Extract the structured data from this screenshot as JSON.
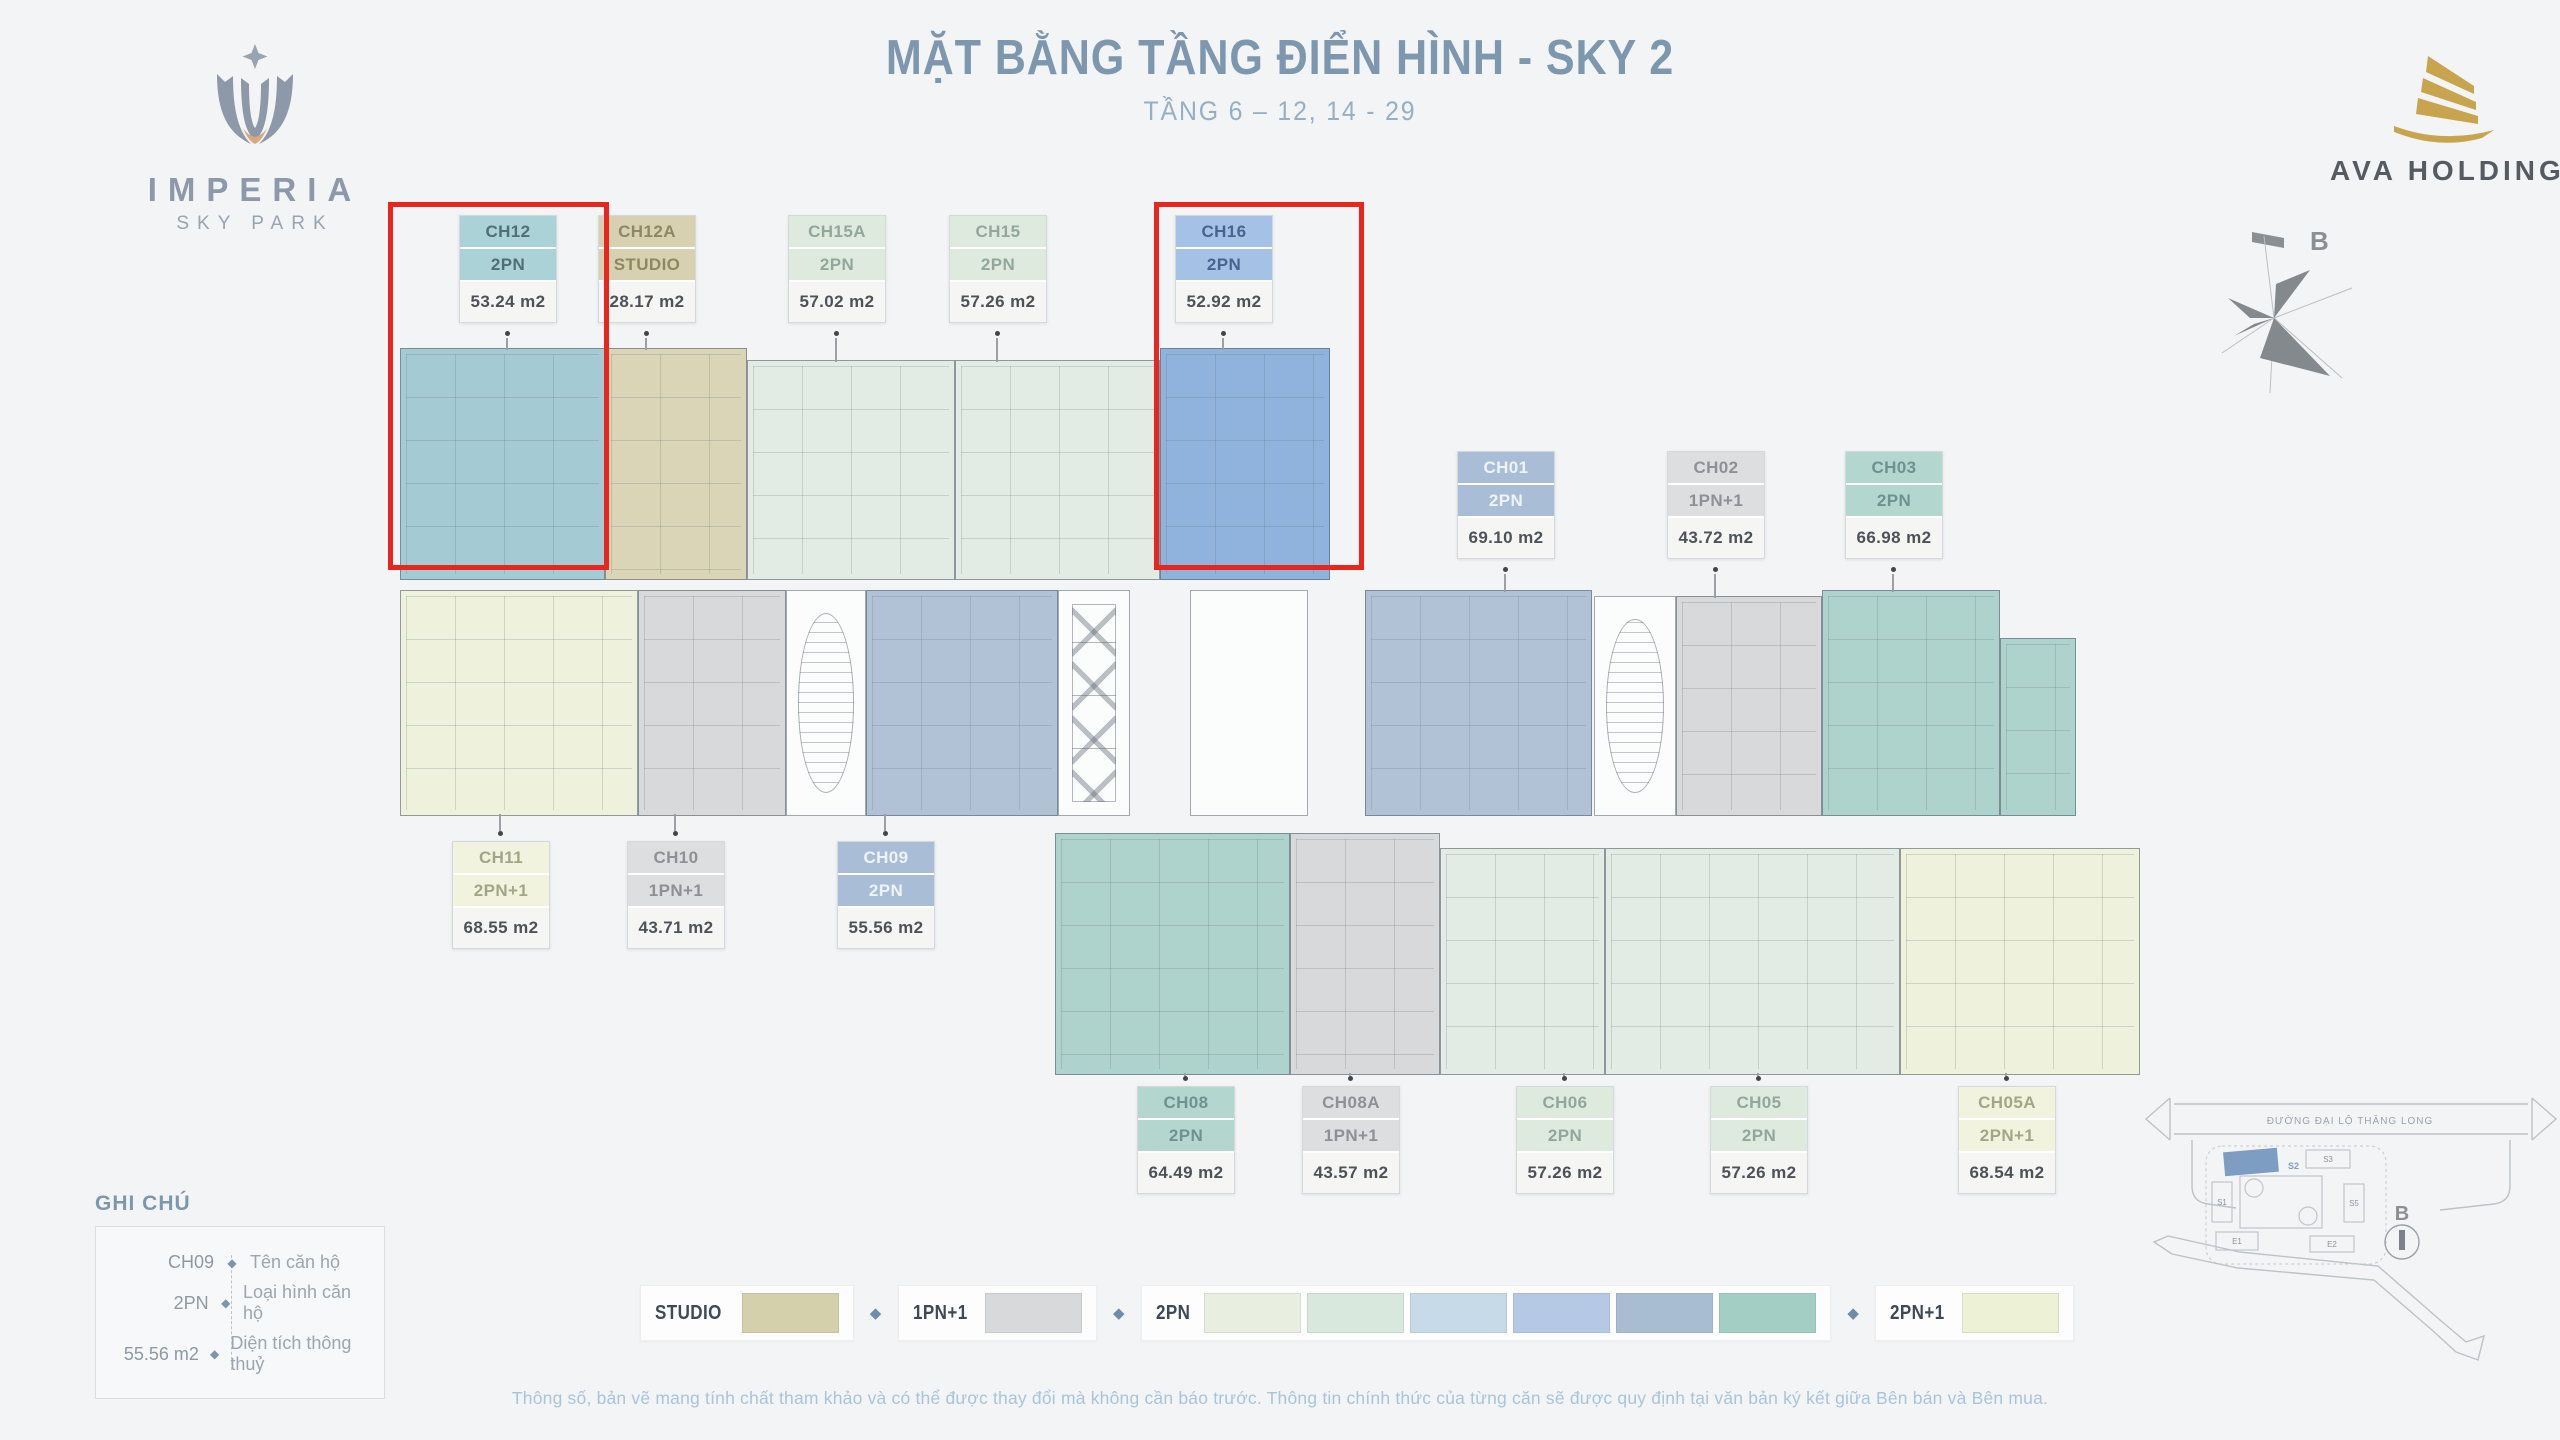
{
  "header": {
    "title": "MẶT BẰNG TẦNG ĐIỂN HÌNH - SKY 2",
    "subtitle": "TẦNG 6 – 12, 14 - 29",
    "imperia_logo": {
      "line1": "IMPERIA",
      "line2": "SKY PARK"
    },
    "ava_logo": "AVA HOLDINGS",
    "compass_label": "B"
  },
  "plan": {
    "highlight_color": "#e8261d",
    "units": [
      {
        "code": "CH12",
        "type": "2PN",
        "area": "53.24 m2",
        "color": "teal",
        "highlighted": true
      },
      {
        "code": "CH12A",
        "type": "STUDIO",
        "area": "28.17 m2",
        "color": "beige",
        "highlighted": false
      },
      {
        "code": "CH15A",
        "type": "2PN",
        "area": "57.02 m2",
        "color": "pale",
        "highlighted": false
      },
      {
        "code": "CH15",
        "type": "2PN",
        "area": "57.26 m2",
        "color": "pale",
        "highlighted": false
      },
      {
        "code": "CH16",
        "type": "2PN",
        "area": "52.92 m2",
        "color": "blue",
        "highlighted": true
      },
      {
        "code": "CH01",
        "type": "2PN",
        "area": "69.10 m2",
        "color": "bluegray",
        "highlighted": false
      },
      {
        "code": "CH02",
        "type": "1PN+1",
        "area": "43.72 m2",
        "color": "gray",
        "highlighted": false
      },
      {
        "code": "CH03",
        "type": "2PN",
        "area": "66.98 m2",
        "color": "teal2",
        "highlighted": false
      },
      {
        "code": "CH11",
        "type": "2PN+1",
        "area": "68.55 m2",
        "color": "cream",
        "highlighted": false
      },
      {
        "code": "CH10",
        "type": "1PN+1",
        "area": "43.71 m2",
        "color": "gray",
        "highlighted": false
      },
      {
        "code": "CH09",
        "type": "2PN",
        "area": "55.56 m2",
        "color": "bluegray",
        "highlighted": false
      },
      {
        "code": "CH08",
        "type": "2PN",
        "area": "64.49 m2",
        "color": "teal2",
        "highlighted": false
      },
      {
        "code": "CH08A",
        "type": "1PN+1",
        "area": "43.57 m2",
        "color": "gray",
        "highlighted": false
      },
      {
        "code": "CH06",
        "type": "2PN",
        "area": "57.26 m2",
        "color": "pale",
        "highlighted": false
      },
      {
        "code": "CH05",
        "type": "2PN",
        "area": "57.26 m2",
        "color": "pale",
        "highlighted": false
      },
      {
        "code": "CH05A",
        "type": "2PN+1",
        "area": "68.54 m2",
        "color": "cream",
        "highlighted": false
      }
    ]
  },
  "palette": {
    "teal": {
      "header": "#abd2d6",
      "fill": "#a4cbd4",
      "text": "#4f6e77"
    },
    "teal2": {
      "header": "#b3d6cf",
      "fill": "#aed3cc",
      "text": "#6d948c"
    },
    "beige": {
      "header": "#d7d1b1",
      "fill": "#dbd5b8",
      "text": "#8d885f"
    },
    "pale": {
      "header": "#dfeadf",
      "fill": "#e2ece4",
      "text": "#92a79c"
    },
    "blue": {
      "header": "#a5c1e5",
      "fill": "#8fb3dd",
      "text": "#47648e"
    },
    "bluegray": {
      "header": "#a9bed6",
      "fill": "#b2c2d6",
      "text": "#eef3f7"
    },
    "gray": {
      "header": "#dddedf",
      "fill": "#d7d9da",
      "text": "#8d9196"
    },
    "cream": {
      "header": "#f1f3de",
      "fill": "#eef1db",
      "text": "#a3a686"
    }
  },
  "legend_note": {
    "title": "GHI CHÚ",
    "diamond": "◆",
    "rows": [
      {
        "sample": "CH09",
        "label": "Tên căn hộ"
      },
      {
        "sample": "2PN",
        "label": "Loại hình căn hộ"
      },
      {
        "sample": "55.56 m2",
        "label": "Diện tích thông thuỷ"
      }
    ]
  },
  "type_legend": {
    "diamond": "◆",
    "groups": [
      {
        "label": "STUDIO",
        "swatches": [
          "#d5d0ac"
        ]
      },
      {
        "label": "1PN+1",
        "swatches": [
          "#d8d9da"
        ]
      },
      {
        "label": "2PN",
        "swatches": [
          "#e9efe0",
          "#d8e8dc",
          "#c6dbe7",
          "#b6c9e4",
          "#a8bcd2",
          "#a3cec4"
        ]
      },
      {
        "label": "2PN+1",
        "swatches": [
          "#edf1d5"
        ]
      }
    ]
  },
  "site_map": {
    "street": "ĐƯỜNG ĐẠI LỘ THĂNG LONG",
    "buildings": [
      "S1",
      "S2",
      "S3",
      "S5",
      "E1",
      "E2"
    ],
    "highlighted_building": "S2",
    "compass_label": "B"
  },
  "disclaimer": "Thông số, bản vẽ mang tính chất tham khảo và có thể được thay đổi mà không cần báo trước. Thông tin chính thức của từng căn sẽ được quy định tại văn bản ký kết giữa Bên bán và Bên mua."
}
